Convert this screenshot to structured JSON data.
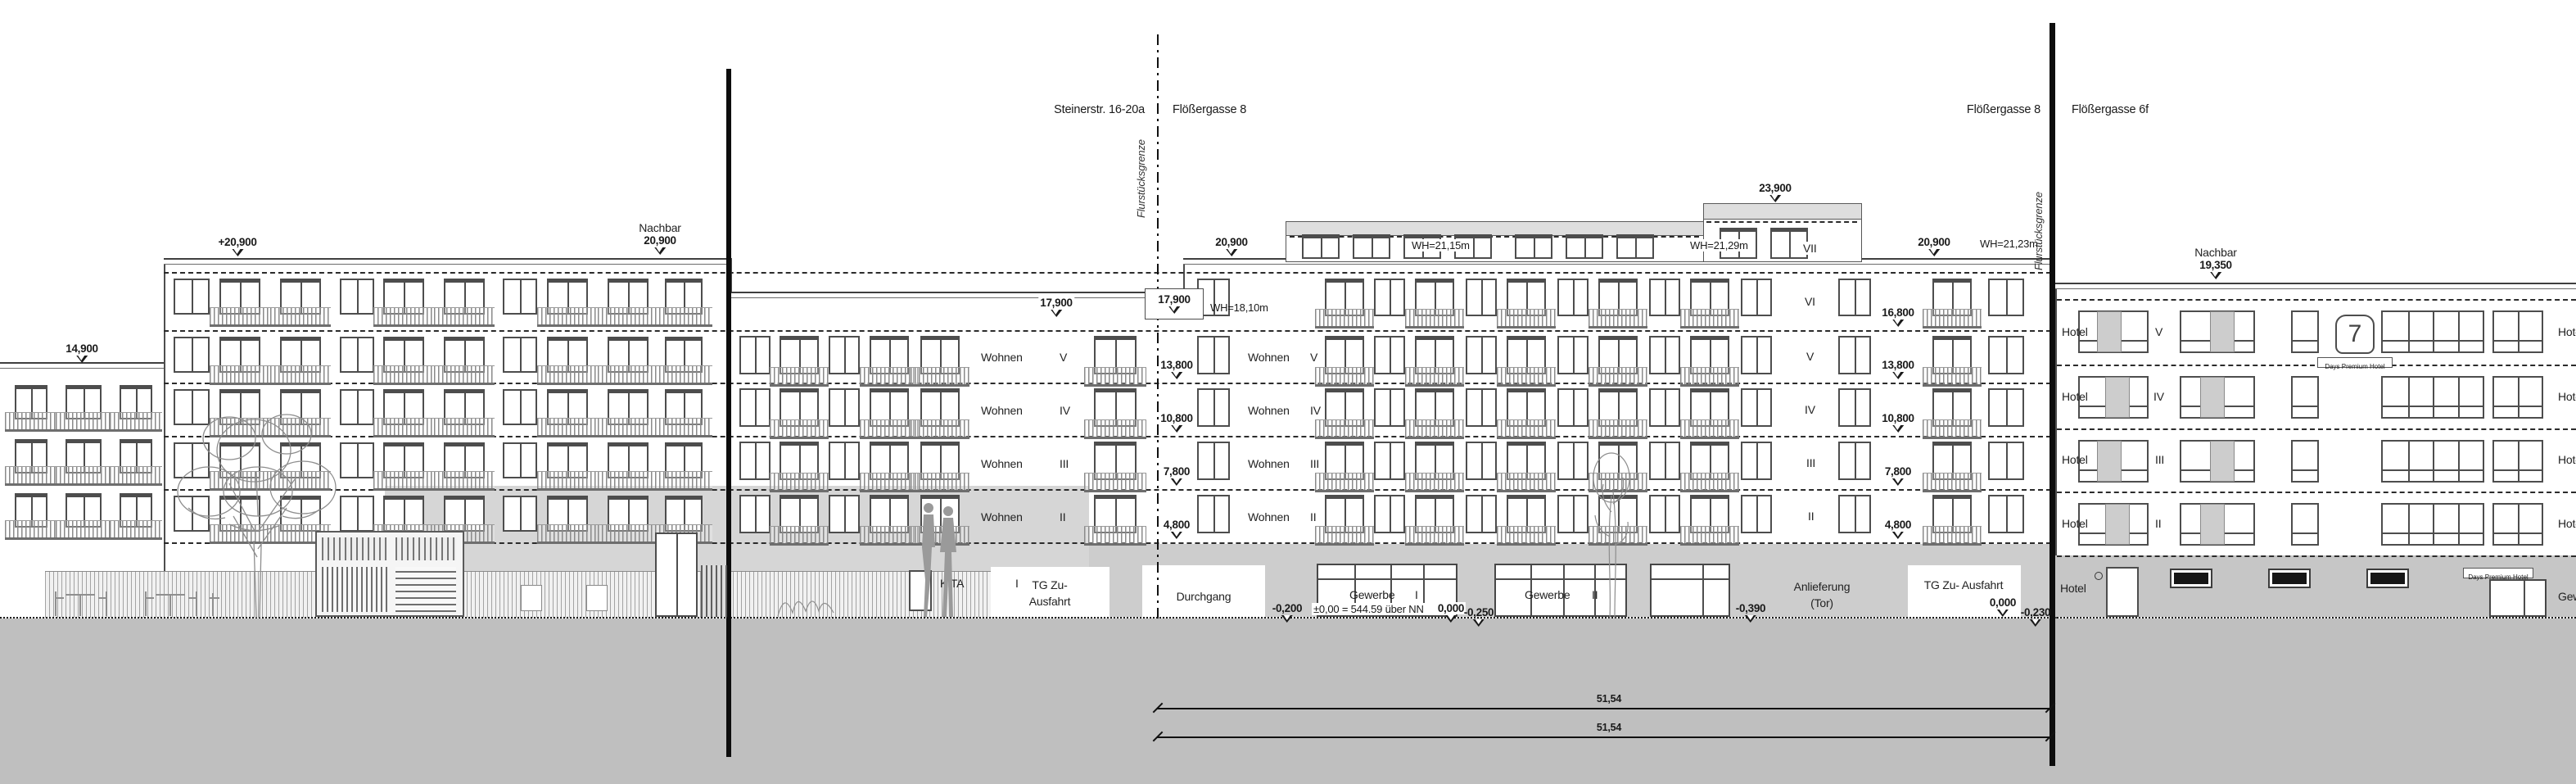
{
  "header": {
    "street_left_a": "Steinerstr. 16-20a",
    "street_left_b": "Flößergasse 8",
    "street_right_a": "Flößergasse 8",
    "street_right_b": "Flößergasse 6f"
  },
  "boundary": {
    "label": "Flurstücksgrenze"
  },
  "levels": {
    "annex_roof": "14,900",
    "left_parapet_plus": "+20,900",
    "nachbar_left_name": "Nachbar",
    "nachbar_left_value": "20,900",
    "center_parapet_left": "20,900",
    "roof_top": "23,900",
    "center_parapet_right": "20,900",
    "attic_left": "17,900",
    "attic_boxed": "17,900",
    "wh_attic": "WH=18,10m",
    "wh_roof_left": "WH=21,15m",
    "wh_roof_mid": "WH=21,29m",
    "wh_roof_right": "WH=21,23m",
    "nachbar_right_name": "Nachbar",
    "nachbar_right_value": "19,350",
    "col_left": [
      "13,800",
      "10,800",
      "7,800",
      "4,800"
    ],
    "col_right": [
      "16,800",
      "13,800",
      "10,800",
      "7,800",
      "4,800"
    ],
    "ground_zero_left": "0,000",
    "ground_zero_right": "0,000",
    "minus_020": "-0,200",
    "minus_025": "-0,250",
    "minus_039": "-0,390",
    "minus_023": "-0,230",
    "nn_reference": "±0,00 = 544.59 über NN"
  },
  "floors": {
    "wohnen_label": "Wohnen",
    "wohnen_numerals": [
      "V",
      "IV",
      "III",
      "II"
    ],
    "right_numerals": [
      "VI",
      "V",
      "IV",
      "III",
      "II"
    ],
    "roof_numeral": "VII",
    "hotel_label": "Hotel",
    "hotel_numerals": [
      "V",
      "IV",
      "III",
      "II"
    ],
    "hotel_cut_label": "Hotel"
  },
  "ground": {
    "kita": "KITA",
    "kita_num": "I",
    "tg1_line1": "TG Zu-",
    "tg1_line2": "Ausfahrt",
    "durchgang": "Durchgang",
    "gewerbe1": "Gewerbe",
    "gewerbe1_num": "I",
    "gewerbe2": "Gewerbe",
    "gewerbe2_num": "II",
    "anlieferung_line1": "Anlieferung",
    "anlieferung_line2": "(Tor)",
    "tg2": "TG Zu- Ausfahrt",
    "hotel_ground": "Hotel",
    "gewerbe_cut": "Gewerbe"
  },
  "badge": {
    "number": "7",
    "text": "Days Premium Hotel",
    "text_ground": "Days Premium Hotel"
  },
  "dimensions": {
    "total_1": "51,54",
    "total_2": "51,54"
  },
  "colors": {
    "line": "#4d4d4d",
    "gray_facade": "#d6d6d6",
    "ground_gray": "#bfbfbf",
    "wall_gray": "#cdcdcd",
    "accent_dark": "#111111"
  }
}
